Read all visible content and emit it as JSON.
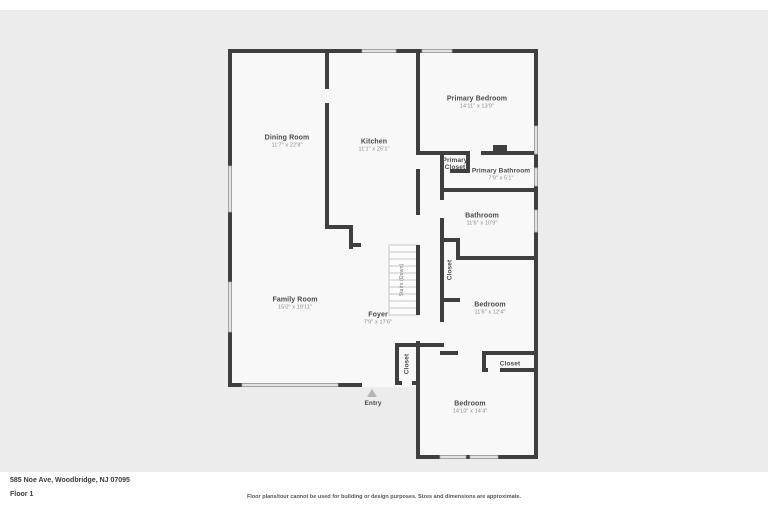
{
  "canvas": {
    "background": "#ececec",
    "wall_color": "#3f3f3f",
    "floor_color": "#f8f8f8",
    "window_color": "#e2e2e2"
  },
  "rooms": {
    "dining_room": {
      "name": "Dining Room",
      "dims": "11'7\" x 22'8\""
    },
    "kitchen": {
      "name": "Kitchen",
      "dims": "11'1\" x 25'1\""
    },
    "primary_bedroom": {
      "name": "Primary Bedroom",
      "dims": "14'11\" x 13'9\""
    },
    "primary_closet": {
      "name": "Primary Closet"
    },
    "primary_bathroom": {
      "name": "Primary Bathroom",
      "dims": "7'9\" x 5'1\""
    },
    "bathroom": {
      "name": "Bathroom",
      "dims": "11'6\" x 10'9\""
    },
    "hall_closet": {
      "name": "Closet"
    },
    "bedroom_2": {
      "name": "Bedroom",
      "dims": "11'6\" x 12'4\""
    },
    "family_room": {
      "name": "Family Room",
      "dims": "15'0\" x 19'11\""
    },
    "foyer": {
      "name": "Foyer",
      "dims": "7'9\" x 17'6\""
    },
    "stairs": {
      "name": "Stairs (Down)"
    },
    "foyer_closet": {
      "name": "Closet"
    },
    "bedroom_3_closet": {
      "name": "Closet"
    },
    "bedroom_3": {
      "name": "Bedroom",
      "dims": "14'10\" x 14'4\""
    },
    "entry": {
      "name": "Entry"
    }
  },
  "footer": {
    "address": "585 Noe Ave, Woodbridge, NJ 07095",
    "floor_label": "Floor 1",
    "disclaimer": "Floor plans/tour cannot be used for building or design purposes. Sizes and dimensions are approximate."
  }
}
